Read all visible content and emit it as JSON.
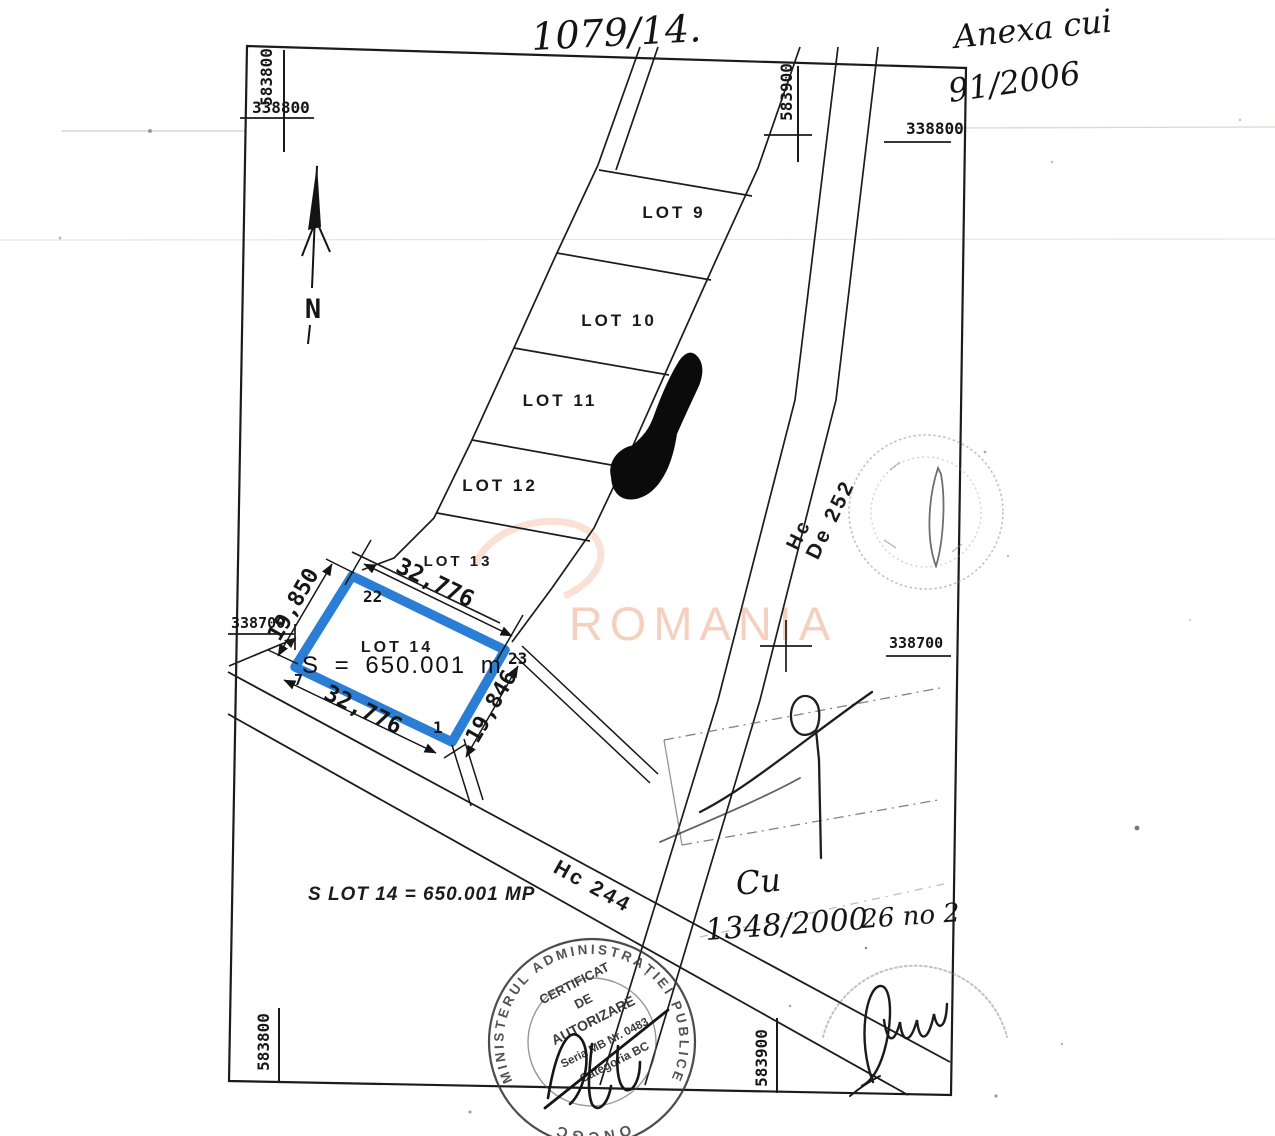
{
  "handwriting": {
    "case_number": "1079/14.",
    "annex_line1": "Anexa cui",
    "annex_line2": "91/2006",
    "cu": "Cu",
    "doc_number": "1348/2000",
    "doc_suffix": "26 no 2"
  },
  "grid": {
    "top_left_vertical": "583800",
    "top_left_horizontal": "338800",
    "top_right_vertical": "583900",
    "top_right_horizontal": "338800",
    "mid_left": "338700",
    "mid_right": "338700",
    "bottom_left_vertical": "583800",
    "bottom_mid_vertical": "583900"
  },
  "compass": {
    "north_label": "N"
  },
  "lots": [
    {
      "label": "LOT 9"
    },
    {
      "label": "LOT 10"
    },
    {
      "label": "LOT 11"
    },
    {
      "label": "LOT 12"
    },
    {
      "label": "LOT 13"
    }
  ],
  "lot14": {
    "label": "LOT 14",
    "area_text": "S = 650.001 m",
    "dim_top": "32,776",
    "dim_left": "19,850",
    "dim_bottom": "32,776",
    "dim_right": "19,846",
    "vertex_top": "22",
    "vertex_right": "23",
    "vertex_bottom": "1",
    "vertex_left": "7",
    "outline_color": "#1a74d2"
  },
  "roads": {
    "hc_label": "Hc",
    "de_label": "De 252",
    "hc244_label": "Hc 244"
  },
  "notes": {
    "area_summary": "S LOT 14 = 650.001 MP"
  },
  "watermark": {
    "text": "ROMANIA",
    "color": "#f6ccb9"
  },
  "stamps": {
    "ring_top_text": "MINISTERUL ADMINISTRAȚIEI PUBLICE",
    "ring_bottom_text": "ONCGC",
    "cert_line1": "CERTIFICAT",
    "cert_line2": "DE",
    "cert_line3": "AUTORIZARE",
    "cert_line4": "Seria MB Nr. 0483",
    "cert_line5": "Categoria BC"
  }
}
